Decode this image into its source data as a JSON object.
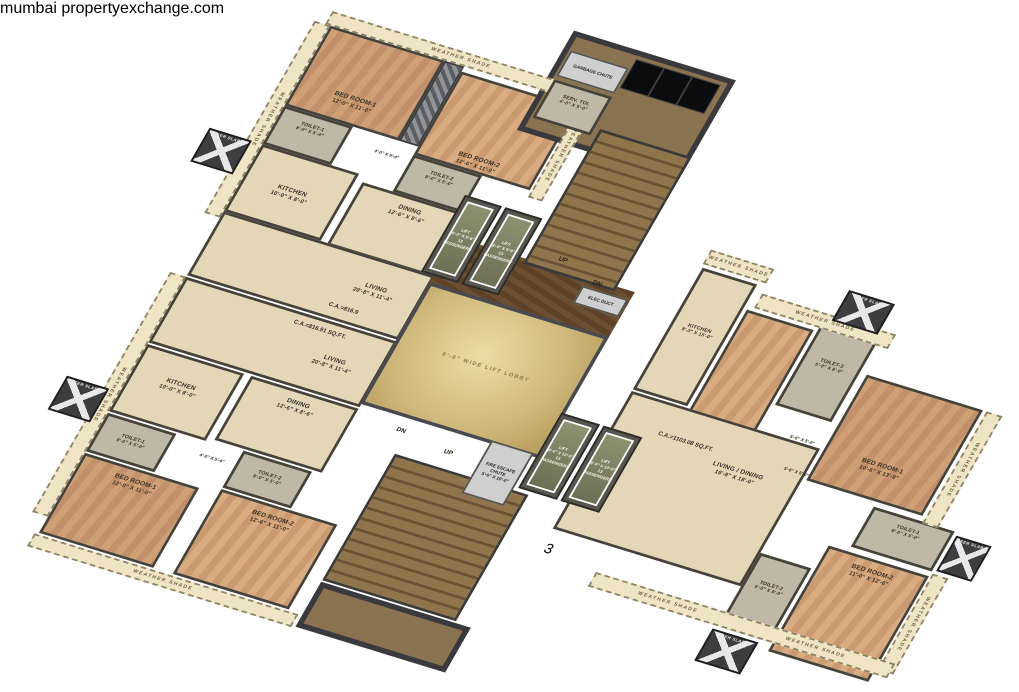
{
  "watermark": {
    "brand_city": "mumbai",
    "brand_rest": "propertyexchange",
    "brand_tld": ".com"
  },
  "labels": {
    "weather_shade": "WEATHER SHADE",
    "ser_slab": "SER SLAB",
    "up": "UP",
    "dn": "DN"
  },
  "core": {
    "garbage_chute": "GARBAGE CHUTE",
    "serv_toi": {
      "name": "SERV. TOI.",
      "dims": "4'-0\" X 5'-0\""
    },
    "elec_duct": "ELEC DUCT",
    "fire_escape_chute": {
      "name": "FIRE ESCAPE CHUTE",
      "dims": "5'-0\" X 10'-0\""
    },
    "lift_upper": {
      "name": "LIFT",
      "dims": "6'-0\" X 5'-6\"",
      "capacity": "13 PASSENGERS"
    },
    "lift_lower": {
      "name": "LIFT",
      "dims": "6'-0\" X 10'-0\"",
      "capacity": "13 PASSENGERS"
    },
    "lift_lobby": "6'-0\" WIDE LIFT LOBBY"
  },
  "flat_top": {
    "carpet_area": "C.A.=816.9",
    "bedroom1": {
      "name": "BED ROOM-1",
      "dims": "12'-0\" X 11'-0\""
    },
    "bedroom2": {
      "name": "BED ROOM-2",
      "dims": "12'-6\" X 11'-0\""
    },
    "toilet1": {
      "name": "TOILET-1",
      "dims": "8'-0\" X 5'-0\""
    },
    "toilet2": {
      "name": "TOILET-2",
      "dims": "8'-0\" X 5'-0\""
    },
    "kitchen": {
      "name": "KITCHEN",
      "dims": "10'-0\" X 8'-0\""
    },
    "dining": {
      "name": "DINING",
      "dims": "12'-6\" X 8'-6\""
    },
    "living": {
      "name": "LIVING",
      "dims": "20'-8\" X 11'-4\""
    },
    "passage_dim": "4'-0\" X 5'-4\""
  },
  "flat_left": {
    "carpet_area": "C.A.=816.91 SQ.FT.",
    "bedroom1": {
      "name": "BED ROOM-1",
      "dims": "12'-0\" X 11'-0\""
    },
    "bedroom2": {
      "name": "BED ROOM-2",
      "dims": "12'-6\" X 11'-0\""
    },
    "toilet1": {
      "name": "TOILET-1",
      "dims": "8'-0\" X 5'-0\""
    },
    "toilet2": {
      "name": "TOILET-2",
      "dims": "8'-0\" X 5'-0\""
    },
    "kitchen": {
      "name": "KITCHEN",
      "dims": "10'-0\" X 8'-0\""
    },
    "dining": {
      "name": "DINING",
      "dims": "12'-6\" X 8'-6\""
    },
    "living": {
      "name": "LIVING",
      "dims": "20'-8\" X 11'-4\""
    },
    "passage_dim": "4'-0\" X 5'-4\""
  },
  "flat_right": {
    "carpet_area": "C.A.=1103.08 SQ.FT.",
    "unit_no": "3",
    "kitchen": {
      "name": "KITCHEN",
      "dims": "8'-3\" X 15'-0\""
    },
    "bedroom3": {
      "name": "BED ROOM-3",
      "dims": "10'-6\" X 13'-9\""
    },
    "toilet3": {
      "name": "TOILET-3",
      "dims": "5'-0\" X 8'-0\""
    },
    "bedroom1": {
      "name": "BED ROOM-1",
      "dims": "10'-6\" X 13'-9\""
    },
    "toilet1": {
      "name": "TOILET-1",
      "dims": "8'-0\" X 5'-0\""
    },
    "living_dining": {
      "name": "LIVING / DINING",
      "dims": "18'-8\" X 18'-0\""
    },
    "bedroom2": {
      "name": "BED ROOM-2",
      "dims": "11'-0\" X 12'-6\""
    },
    "toilet2": {
      "name": "TOILET-2",
      "dims": "5'-0\" X 8'-0\""
    },
    "passage_dim": "5'-6\" X 5'-0\""
  },
  "colors": {
    "brand_green": "#94bf3d",
    "brand_orange": "#ee7e20",
    "weather_shade_fill": "#efe5c4",
    "wall": "#45423a"
  }
}
